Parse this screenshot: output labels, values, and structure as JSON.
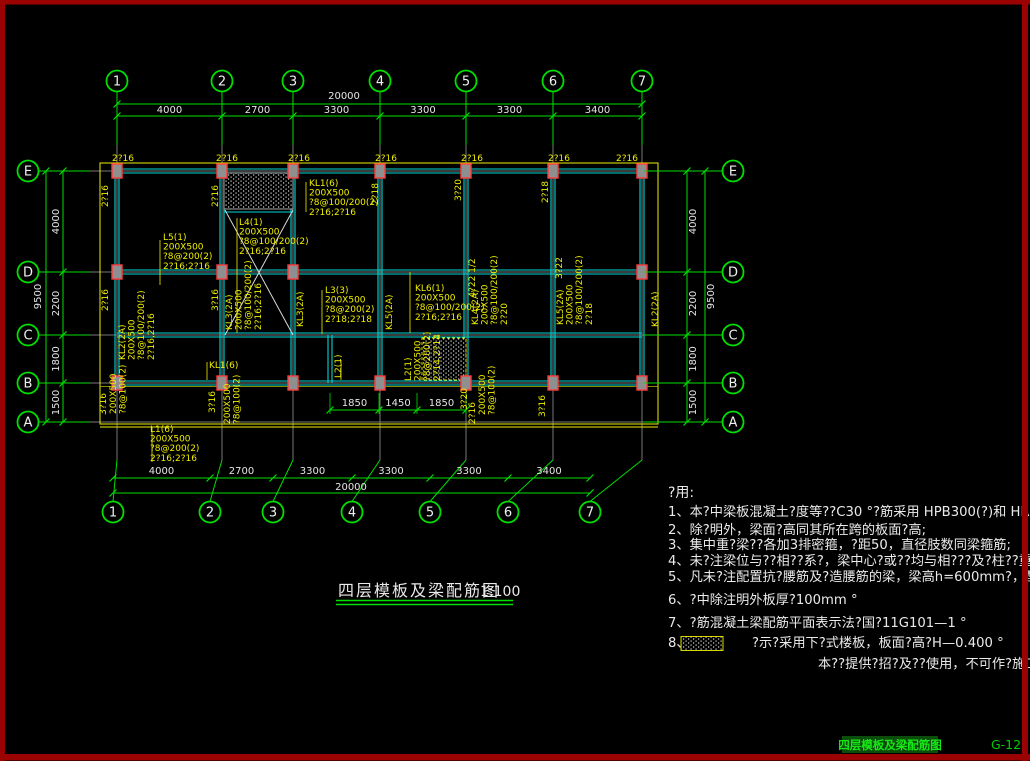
{
  "colors": {
    "green": "#00df00",
    "cyan": "#00d8d8",
    "yellow": "#efef00",
    "dim_yellow": "#b9b900",
    "gray": "#787878",
    "white": "#e6e6e6",
    "border_red": "#9b0303",
    "column_red": "#ff3b3b",
    "column_fill": "#8f8f8f",
    "status_green": "#17e817",
    "status_hilite": "#0b4d0b"
  },
  "title_block": {
    "title": "四层模板及梁配筋图",
    "scale": "1:100"
  },
  "status_bar": {
    "doc_name": "四层模板及梁配筋图",
    "sheet_no": "G-12"
  },
  "axes": {
    "top": {
      "bubbles": [
        "1",
        "2",
        "3",
        "4",
        "5",
        "6",
        "7"
      ],
      "segments": [
        "4000",
        "2700",
        "3300",
        "3300",
        "3300",
        "3400"
      ],
      "total": "20000"
    },
    "bottom": {
      "bubbles": [
        "1",
        "2",
        "3",
        "4",
        "5",
        "6",
        "7"
      ],
      "segments": [
        "4000",
        "2700",
        "3300",
        "3300",
        "3300",
        "3400"
      ],
      "total": "20000"
    },
    "left": {
      "bubbles": [
        "E",
        "D",
        "C",
        "B",
        "A"
      ],
      "segments": [
        "4000",
        "2200",
        "1800",
        "1500"
      ],
      "total": "9500"
    },
    "right": {
      "bubbles": [
        "E",
        "D",
        "C",
        "B",
        "A"
      ],
      "segments": [
        "4000",
        "2200",
        "1800",
        "1500"
      ],
      "total": "9500"
    }
  },
  "canopy_dims": [
    "1850",
    "1450",
    "1850"
  ],
  "plan_labels": {
    "top_bars": [
      {
        "t": "2?16",
        "x": 112
      },
      {
        "t": "2?16",
        "x": 216
      },
      {
        "t": "2?16",
        "x": 288
      },
      {
        "t": "2?16",
        "x": 375
      },
      {
        "t": "2?16",
        "x": 461
      },
      {
        "t": "2?16",
        "x": 548
      },
      {
        "t": "2?16",
        "x": 616
      }
    ],
    "h_blocks": [
      {
        "x": 163,
        "y": 240,
        "lines": [
          "L5(1)",
          "200X500",
          "?8@200(2)",
          "2?16;2?16"
        ]
      },
      {
        "x": 239,
        "y": 225,
        "lines": [
          "L4(1)",
          "200X500",
          "?8@100/200(2)",
          "2?16;2?16"
        ]
      },
      {
        "x": 309,
        "y": 186,
        "lines": [
          "KL1(6)",
          "200X500",
          "?8@100/200(2)",
          "2?16;2?16"
        ]
      },
      {
        "x": 325,
        "y": 293,
        "lines": [
          "L3(3)",
          "200X500",
          "?8@200(2)",
          "2?18;2?18"
        ]
      },
      {
        "x": 415,
        "y": 291,
        "lines": [
          "KL6(1)",
          "200X500",
          "?8@100/200(2)",
          "2?16;2?16"
        ]
      },
      {
        "x": 209,
        "y": 368,
        "lines": [
          "KL1(6)"
        ]
      },
      {
        "x": 150,
        "y": 432,
        "lines": [
          "L1(6)",
          "200X500",
          "?8@200(2)",
          "2?16;2?16"
        ]
      }
    ],
    "v_blocks": [
      {
        "x": 232,
        "y": 330,
        "lines": [
          "KL3(2A)",
          "200X500",
          "?8@100/200(2)",
          "2?16;2?16"
        ]
      },
      {
        "x": 303,
        "y": 327,
        "lines": [
          "KL3(2A)"
        ]
      },
      {
        "x": 392,
        "y": 330,
        "lines": [
          "KL5(2A)"
        ]
      },
      {
        "x": 478,
        "y": 325,
        "lines": [
          "KL4(2A)",
          "200X500",
          "?8@100/200(2)",
          "2?20"
        ]
      },
      {
        "x": 563,
        "y": 325,
        "lines": [
          "KL5(2A)",
          "200X500",
          "?8@100/200(2)",
          "2?18"
        ]
      },
      {
        "x": 658,
        "y": 327,
        "lines": [
          "KL2(2A)"
        ]
      },
      {
        "x": 125,
        "y": 360,
        "lines": [
          "KL2(2A)",
          "200X500",
          "?8@100/200(2)",
          "2?16,2?16"
        ]
      },
      {
        "x": 341,
        "y": 378,
        "lines": [
          "L2(1)"
        ]
      },
      {
        "x": 411,
        "y": 381,
        "lines": [
          "L2(1)",
          "200X500",
          "?8@200(2)",
          "2?14;2?14"
        ]
      },
      {
        "x": 116,
        "y": 414,
        "lines": [
          "200X500",
          "?8@100(2)"
        ]
      },
      {
        "x": 230,
        "y": 424,
        "lines": [
          "200X500",
          "?8@100(2)"
        ]
      },
      {
        "x": 485,
        "y": 415,
        "lines": [
          "200X500",
          "?8@100(2)"
        ]
      }
    ],
    "v_bars": [
      {
        "t": "2?16",
        "x": 108,
        "y": 196
      },
      {
        "t": "2?16",
        "x": 218,
        "y": 196
      },
      {
        "t": "2?18",
        "x": 378,
        "y": 194
      },
      {
        "t": "3?20",
        "x": 461,
        "y": 190
      },
      {
        "t": "2?18",
        "x": 548,
        "y": 192
      },
      {
        "t": "2?16",
        "x": 108,
        "y": 300
      },
      {
        "t": "3?16",
        "x": 218,
        "y": 300
      },
      {
        "t": "4?22 1/2",
        "x": 475,
        "y": 278
      },
      {
        "t": "3?22",
        "x": 562,
        "y": 268
      },
      {
        "t": "3?16",
        "x": 106,
        "y": 404
      },
      {
        "t": "3?16",
        "x": 215,
        "y": 402
      },
      {
        "t": "3?20",
        "x": 467,
        "y": 399
      },
      {
        "t": "2?16",
        "x": 475,
        "y": 413
      },
      {
        "t": "3?16",
        "x": 545,
        "y": 406
      }
    ]
  },
  "notes": {
    "heading": "?用:",
    "items": [
      "1、本?中梁板混凝土?度等??C30 °?筋采用 HPB300(?)和 HRB4",
      "2、除?明外，梁面?高同其所在跨的板面?高;",
      "3、集中重?梁??各加3排密箍，?距50，直径肢数同梁箍筋;",
      "4、未?注梁位与??相??系?，梁中心?或??均与相???及?柱??重合;",
      "5、凡未?注配置抗?腰筋及?造腰筋的梁，梁高h=600mm?，配置4?",
      "6、?中除注明外板厚?100mm °",
      "7、?筋混凝土梁配筋平面表示法?国?11G101—1 °"
    ],
    "item8": {
      "prefix": "8、",
      "body": "?示?采用下?式楼板，板面?高?H—0.400 °"
    },
    "footer": "本??提供?招?及??使用，不可作?施工用"
  }
}
